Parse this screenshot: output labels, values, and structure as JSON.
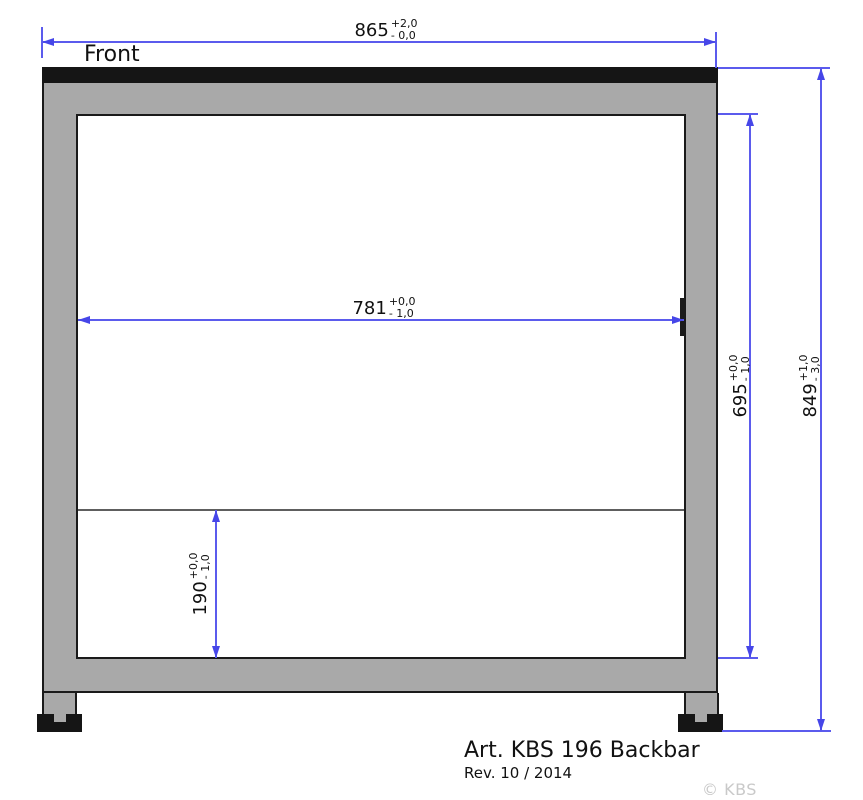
{
  "page": {
    "front_label": "Front",
    "article_title": "Art. KBS 196 Backbar",
    "revision": "Rev. 10 / 2014",
    "watermark": "© KBS Gastrotechnik"
  },
  "dimensions": {
    "overall_width": {
      "value": "865",
      "tol_upper": "+2,0",
      "tol_lower": "- 0,0"
    },
    "inner_width": {
      "value": "781",
      "tol_upper": "+0,0",
      "tol_lower": "- 1,0"
    },
    "inner_height": {
      "value": "695",
      "tol_upper": "+0,0",
      "tol_lower": "- 1,0"
    },
    "overall_height": {
      "value": "849",
      "tol_upper": "+1,0",
      "tol_lower": "- 3,0"
    },
    "base_height": {
      "value": "190",
      "tol_upper": "+0,0",
      "tol_lower": "- 1,0"
    }
  },
  "colors": {
    "dimension_line": "#5b5bed",
    "arrowhead": "#4646e8",
    "frame_gray": "#a9a9a9",
    "outline_black": "#1a1a1a",
    "top_bar_black": "#151515",
    "shelf_line_gray": "#5e5e5e",
    "watermark_gray": "#c9c9c9",
    "background": "#ffffff"
  }
}
